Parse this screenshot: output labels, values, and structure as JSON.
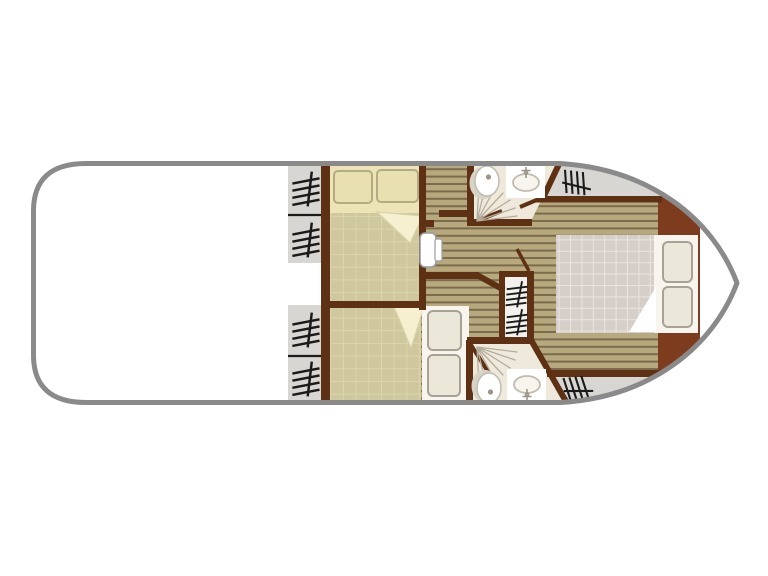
{
  "diagram": {
    "kind": "houseboat-floor-plan",
    "orientation": {
      "bow": "right",
      "stern": "left"
    },
    "areas": [
      "aft-deck",
      "aft-stairs-port",
      "aft-stairs-starboard",
      "port-cabin",
      "starboard-cabin",
      "corridor",
      "port-bathroom",
      "starboard-bathroom",
      "companionway-stairs",
      "forward-master-cabin",
      "bow-deck-port",
      "bow-deck-starboard"
    ],
    "fixtures": {
      "beds": 3,
      "pillows": 6,
      "toilets": 2,
      "basins": 2,
      "showers": 2,
      "doors": 1,
      "door_swing_lines": 4,
      "stair_glyphs": 8
    }
  },
  "colors": {
    "hull_outline": "#8a8a8a",
    "hull_fill": "#ffffff",
    "deck_gray": "#d8d6d2",
    "divider_black": "#1c1c1c",
    "wall_brown": "#5e3115",
    "bulkhead_brown": "#7d3c1e",
    "plank_base": "#b7a97e",
    "plank_line": "#7b6b4c",
    "khaki_base": "#cfc79d",
    "khaki_line": "#dcd5ab",
    "bathroom_floor": "#eee9db",
    "stairs_fill": "#f2f1ee",
    "bed_cream": "#ece4b6",
    "pillow_cream": "#e8e0b0",
    "pillow_cream_border": "#b5ab83",
    "fold_cream": "#f6f0d0",
    "fold_edge": "#d8d2a8",
    "bed_white": "#f7f5ed",
    "pillow_white": "#ebe7d9",
    "pillow_white_border": "#a8a296",
    "duvet_base": "#d6cec9",
    "duvet_line": "#eae5e1",
    "fixture_stroke": "#c2bcb0",
    "fixture_shadow": "#d8d3c7",
    "fixture_dot": "#9a948a",
    "shower_ray": "#b5ad9c",
    "glyph_black": "#1a1a1a",
    "door_white": "#ffffff",
    "door_border": "#9b9b9b"
  }
}
